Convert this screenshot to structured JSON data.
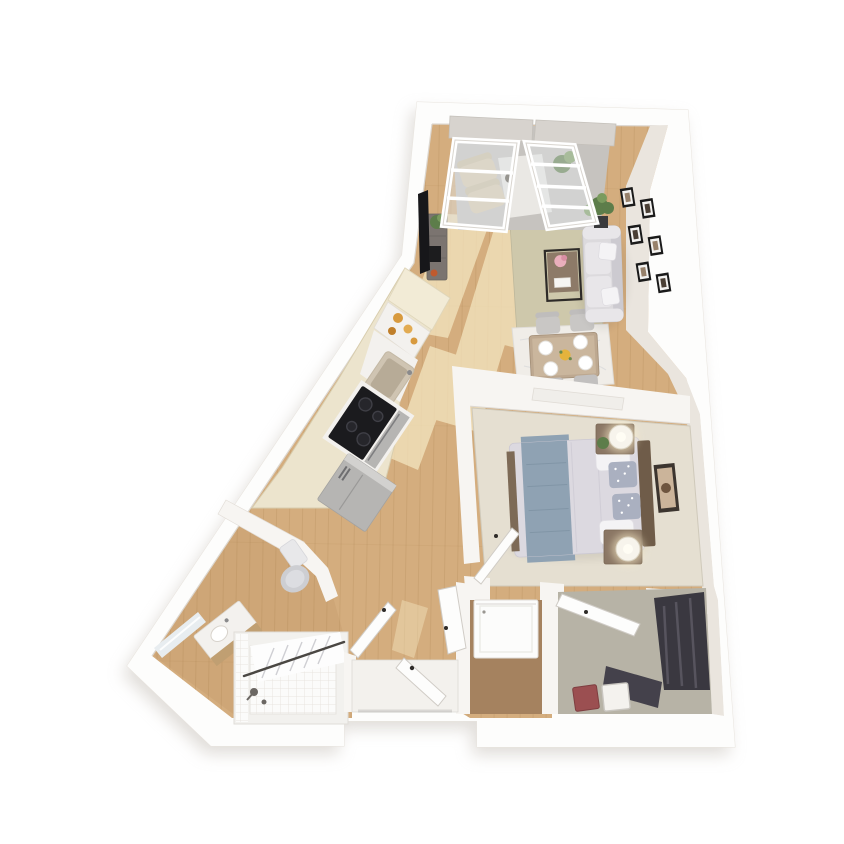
{
  "meta": {
    "kind": "3d-floor-plan-render",
    "text_visible_on_image": "none"
  },
  "palette": {
    "bg": "#ffffff",
    "wall": "#f7f5f2",
    "wall-bright": "#fdfdfc",
    "wall-face": "#eae5de",
    "wall-edge": "#dcd7d0",
    "shadow": "#c2bcb4",
    "wood": "#d4ad7e",
    "wood-shade": "#c79e6f",
    "wood-light": "#f5e8c2",
    "plank": "#a9814f",
    "carpet-bedroom": "#e5dfd1",
    "carpet-closet": "#b7b3a6",
    "laundry-floor": "#a5825f",
    "entry-floor": "#f3f1ed",
    "tile": "#fbfbfa",
    "tile-line": "#e8e5e0",
    "rug-living": "#cec8ab",
    "rug-dining": "#f0ede8",
    "sofa": "#dcdadd",
    "sofa-shade": "#cccad0",
    "sofa-light": "#e8e6e9",
    "pillow": "#f4f3f5",
    "table-wood": "#bda890",
    "table-top": "#cbb79e",
    "chair": "#c9c7c5",
    "plate": "#ffffff",
    "flower-yellow": "#e5b33c",
    "flower-pink": "#e9aebc",
    "console-wood": "#7b7470",
    "tv-black": "#17171a",
    "plant-green": "#5d7d4a",
    "plant-light": "#7a9b5e",
    "frame-black": "#1a1a1a",
    "frame-mat": "#f3f2f0",
    "photo": "#97816b",
    "cabinet": "#ece4cd",
    "cabinet-light": "#f2ebd6",
    "marble": "#f3f1ee",
    "marble-vein": "#d9d9db",
    "steel": "#b6b5b3",
    "steel-light": "#d2d1cf",
    "cooktop": "#1b1b1e",
    "burner": "#26262b",
    "sink-beige": "#cfc4b2",
    "sink-inner": "#b7ab97",
    "jar-amber": "#d89a3e",
    "duvet": "#dcd9e0",
    "blanket": "#8fa2b3",
    "blanket-fold": "#7e93a4",
    "headboard": "#6f5c49",
    "nightstand": "#8a7664",
    "lamp": "#f7f4ec",
    "lamp-glow": "#fff3cd",
    "floral-pillow": "#aab0c0",
    "art-frame": "#3c352f",
    "art-image": "#cbb49a",
    "toilet": "#cdced2",
    "toilet-tank": "#e8e8ea",
    "vanity-wood": "#c09f72",
    "mirror": "#e8edf0",
    "curtain": "#fdfdfd",
    "curtain-fold": "#cfcfd3",
    "rod": "#4a4743",
    "washer": "#fcfcfb",
    "clothes-dark": "#3a3840",
    "clothes-mid": "#57545e",
    "box-maroon": "#9b4f51",
    "box-white": "#f4f2ee",
    "door": "#fdfdfc",
    "door-edge": "#d0ccc6",
    "handle": "#2e2b28",
    "shade-grey": "#d7d3ce",
    "glass": "#dfe4e6",
    "balcony-floor": "#c6c3bf",
    "balcony-rug": "#eae8e4",
    "lounge-chair": "#d9cbb0"
  },
  "scene": {
    "rooms": [
      {
        "name": "living-room",
        "furnishings": [
          "sofa",
          "throw-pillows",
          "coffee-table",
          "pink-flowers",
          "media-console",
          "tv",
          "potted-plant",
          "gallery-wall-six-frames",
          "area-rug"
        ]
      },
      {
        "name": "dining-area",
        "furnishings": [
          "dining-table",
          "four-chairs",
          "four-place-settings",
          "flower-centerpiece",
          "light-rug"
        ]
      },
      {
        "name": "kitchen",
        "furnishings": [
          "tall-cabinet",
          "open-shelf-with-jars",
          "marble-counter",
          "sink",
          "cooktop",
          "oven",
          "refrigerator"
        ]
      },
      {
        "name": "bedroom",
        "furnishings": [
          "bed",
          "gray-blanket",
          "floral-pillows",
          "headboard",
          "two-nightstands",
          "two-drum-lamps",
          "plant",
          "wall-art",
          "carpet"
        ]
      },
      {
        "name": "bathroom",
        "furnishings": [
          "toilet",
          "vanity-sink",
          "leaning-mirror",
          "bathtub-shower",
          "shower-curtain",
          "shower-fixtures"
        ]
      },
      {
        "name": "hallway",
        "furnishings": [
          "open-doors"
        ]
      },
      {
        "name": "entry",
        "furnishings": [
          "front-door",
          "white-threshold"
        ]
      },
      {
        "name": "laundry-closet",
        "furnishings": [
          "washer"
        ]
      },
      {
        "name": "walk-in-closet",
        "furnishings": [
          "hanging-clothes",
          "two-storage-boxes",
          "open-door"
        ]
      },
      {
        "name": "balcony",
        "furnishings": [
          "two-lounge-chairs",
          "rug",
          "plant"
        ],
        "note": "visible-through-windows"
      }
    ],
    "windows": {
      "count": 2,
      "shades": "gray-roller"
    }
  }
}
